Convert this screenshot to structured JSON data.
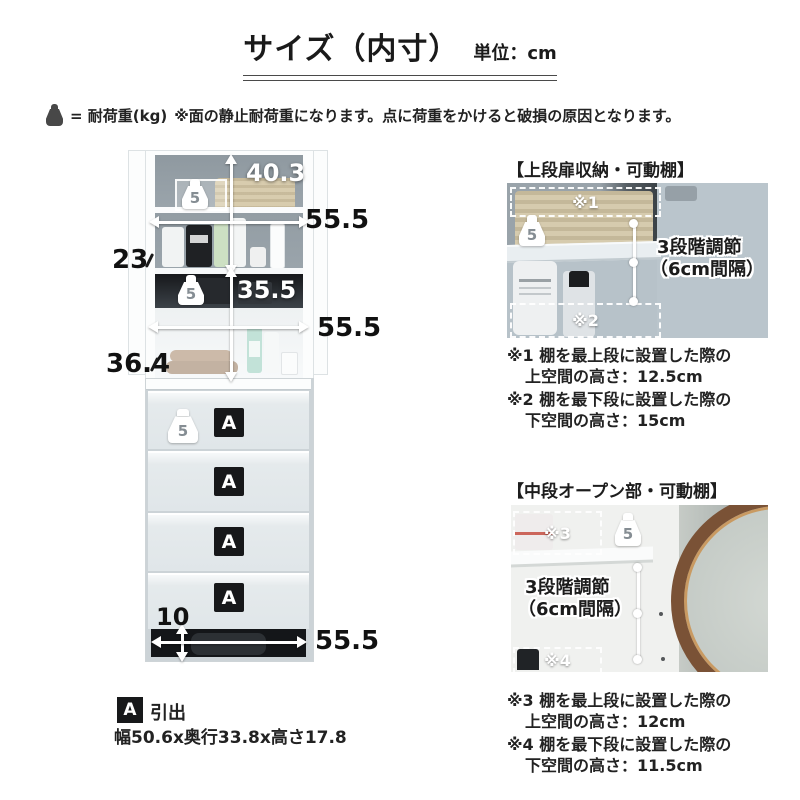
{
  "title": {
    "main": "サイズ（内寸）",
    "unit": "単位：cm"
  },
  "load_note": {
    "label": "= 耐荷重(kg)",
    "text": "※面の静止耐荷重になります。点に荷重をかけると破損の原因となります。"
  },
  "cabinet": {
    "top": {
      "load": "5",
      "height": "40.3",
      "width": "55.5",
      "depth": "23"
    },
    "middle": {
      "load": "5",
      "height": "35.5",
      "width": "55.5",
      "depth": "36.4"
    },
    "drawer_load": "5",
    "drawer_labels": [
      "A",
      "A",
      "A",
      "A"
    ],
    "base": {
      "height": "10",
      "width": "55.5"
    }
  },
  "legend": {
    "badge": "A",
    "name": "引出",
    "size": "幅50.6x奥行33.8x高さ17.8"
  },
  "panels": [
    {
      "title": "【上段扉収納・可動棚】",
      "load": "5",
      "top_marker": "※1",
      "bottom_marker": "※2",
      "adjust_line1": "3段階調節",
      "adjust_line2": "（6cm間隔）",
      "notes": [
        {
          "line1": "※1 棚を最上段に設置した際の",
          "label2": "上空間の高さ：",
          "value2": "12.5cm"
        },
        {
          "line1": "※2 棚を最下段に設置した際の",
          "label2": "下空間の高さ：",
          "value2": "15cm"
        }
      ]
    },
    {
      "title": "【中段オープン部・可動棚】",
      "load": "5",
      "top_marker": "※3",
      "bottom_marker": "※4",
      "adjust_line1": "3段階調節",
      "adjust_line2": "（6cm間隔）",
      "notes": [
        {
          "line1": "※3 棚を最上段に設置した際の",
          "label2": "上空間の高さ：",
          "value2": "12cm"
        },
        {
          "line1": "※4 棚を最下段に設置した際の",
          "label2": "下空間の高さ：",
          "value2": "11.5cm"
        }
      ]
    }
  ],
  "colors": {
    "text": "#1a1a1a",
    "interior_gray": "#97a1a8",
    "mirror_wood": "#7a5236",
    "badge_black": "#17181a"
  }
}
